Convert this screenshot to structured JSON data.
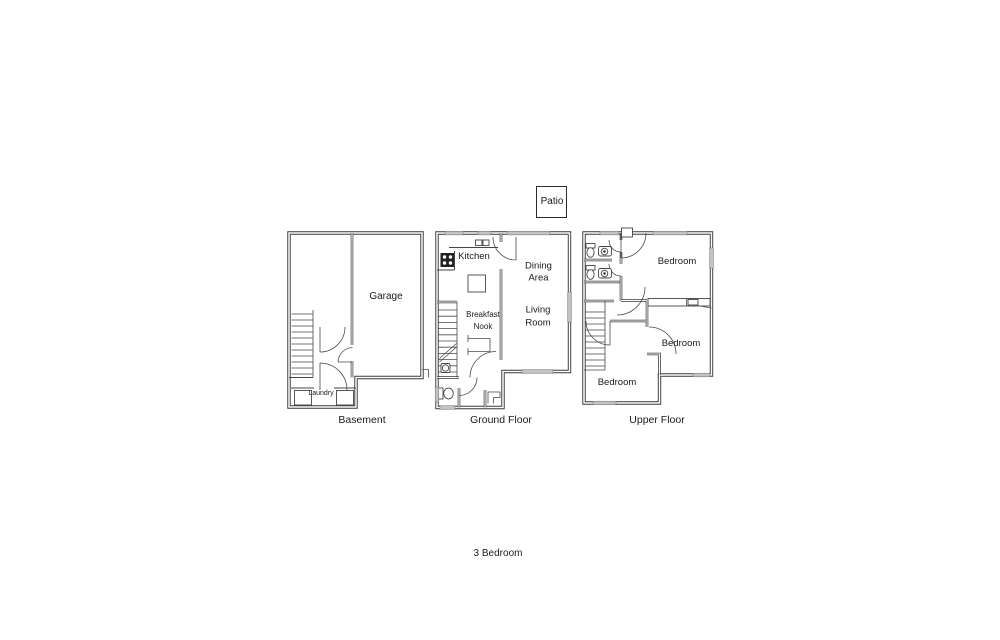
{
  "title": "3 Bedroom",
  "patio": {
    "label": "Patio"
  },
  "floors": {
    "basement": {
      "name": "Basement",
      "rooms": {
        "garage": "Garage",
        "laundry": "Laundry"
      }
    },
    "ground": {
      "name": "Ground Floor",
      "rooms": {
        "kitchen": "Kitchen",
        "dining": [
          "Dining",
          "Area"
        ],
        "living": [
          "Living",
          "Room"
        ],
        "nook": [
          "Breakfast",
          "Nook"
        ]
      }
    },
    "upper": {
      "name": "Upper Floor",
      "rooms": {
        "bedroom1": "Bedroom",
        "bedroom2": "Bedroom",
        "bedroom3": "Bedroom"
      }
    }
  },
  "icons": [
    "stove-icon",
    "kitchen-sink-icon",
    "toilet-icon",
    "bathroom-sink-icon",
    "washer-icon",
    "dryer-icon",
    "stairs",
    "door-arc",
    "window"
  ],
  "colors": {
    "wall": "#383838",
    "window_fill": "#c3c3c3",
    "fixture": "#454545",
    "text": "#1a1a1a",
    "background": "#ffffff"
  }
}
